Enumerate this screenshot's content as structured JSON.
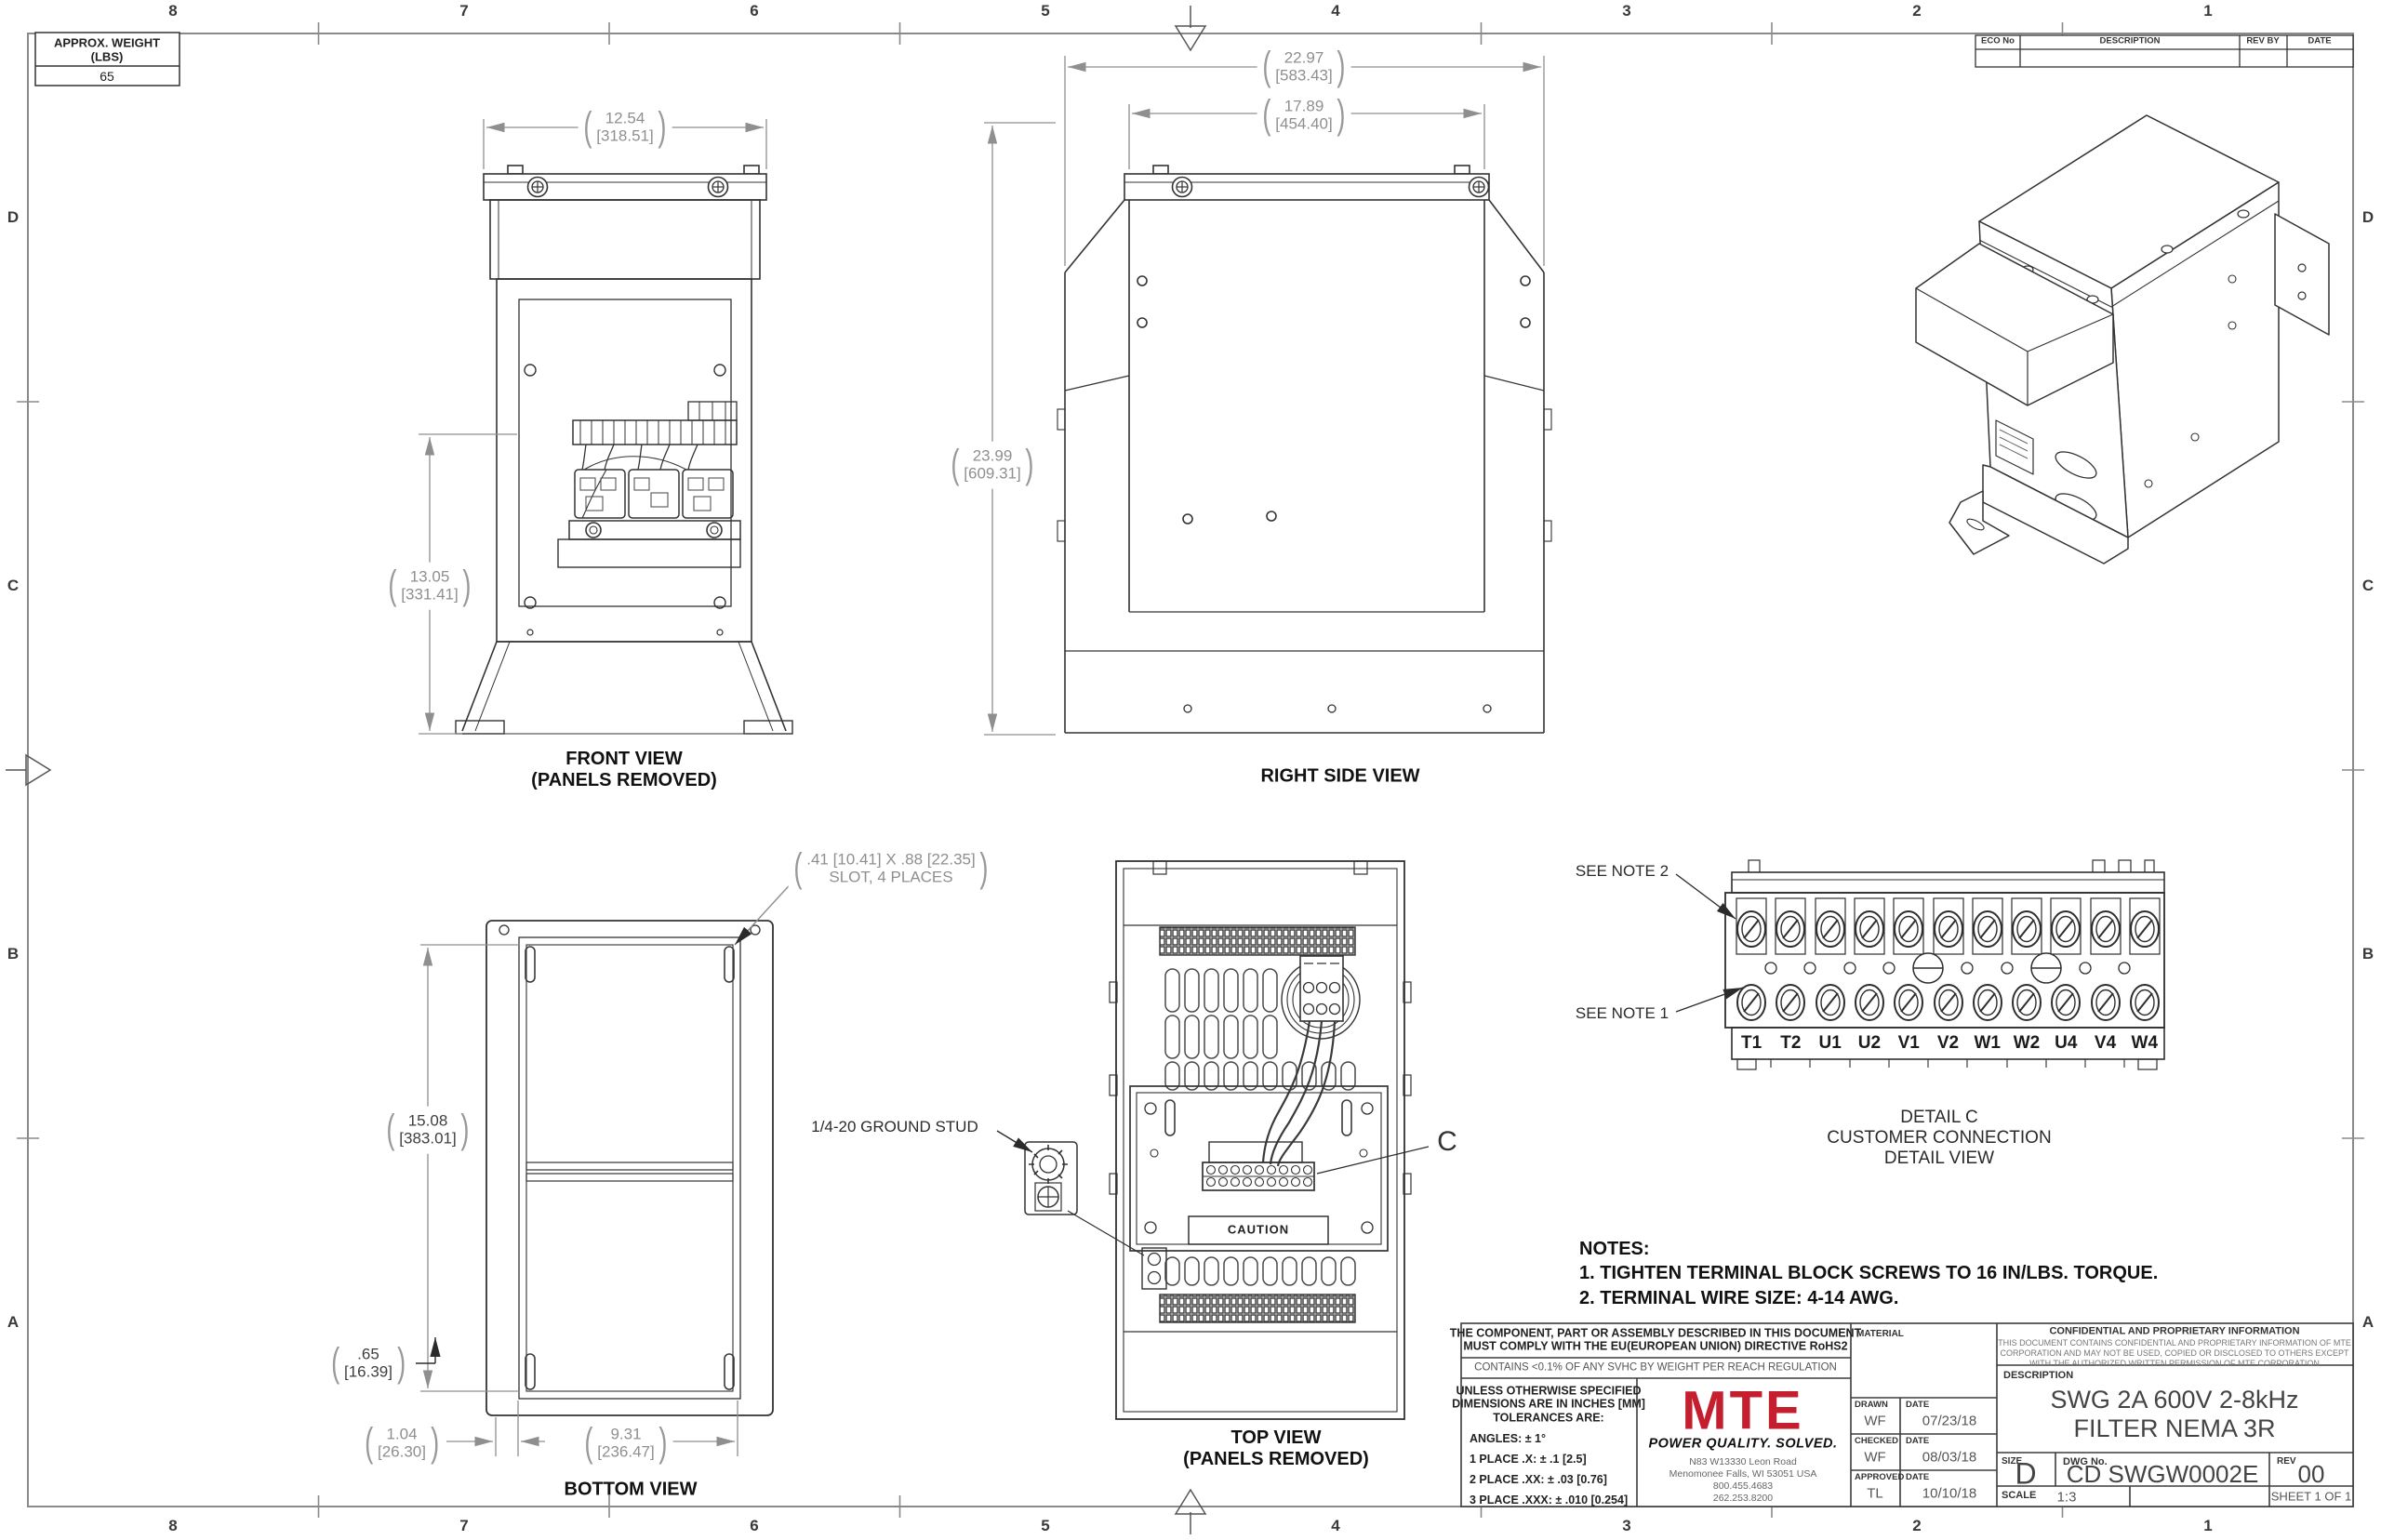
{
  "sheet": {
    "cols": [
      "8",
      "7",
      "6",
      "5",
      "4",
      "3",
      "2",
      "1"
    ],
    "rows": [
      "D",
      "C",
      "B",
      "A"
    ]
  },
  "weight_box": {
    "line1": "APPROX. WEIGHT",
    "line2": "(LBS)",
    "value": "65"
  },
  "eco_table": {
    "col1": "ECO No",
    "col2": "DESCRIPTION",
    "col3": "REV BY",
    "col4": "DATE"
  },
  "views": {
    "front": {
      "label_line1": "FRONT VIEW",
      "label_line2": "(PANELS REMOVED)",
      "dim_width": {
        "in": "12.54",
        "mm": "[318.51]"
      },
      "dim_height": {
        "in": "13.05",
        "mm": "[331.41]"
      }
    },
    "right_side": {
      "label": "RIGHT SIDE VIEW",
      "dim_overall_width": {
        "in": "22.97",
        "mm": "[583.43]"
      },
      "dim_inner_width": {
        "in": "17.89",
        "mm": "[454.40]"
      },
      "dim_height": {
        "in": "23.99",
        "mm": "[609.31]"
      }
    },
    "bottom": {
      "label": "BOTTOM VIEW",
      "slot_note_line1": ".41 [10.41] X .88 [22.35]",
      "slot_note_line2": "SLOT, 4 PLACES",
      "dim_depth": {
        "in": "15.08",
        "mm": "[383.01]"
      },
      "dim_edge": {
        "in": ".65",
        "mm": "[16.39]"
      },
      "dim_offset": {
        "in": "1.04",
        "mm": "[26.30]"
      },
      "dim_span": {
        "in": "9.31",
        "mm": "[236.47]"
      }
    },
    "top": {
      "label_line1": "TOP VIEW",
      "label_line2": "(PANELS REMOVED)",
      "ground_stud_label": "1/4-20 GROUND STUD",
      "caution_label": "CAUTION",
      "detail_ref": "C"
    }
  },
  "detail_c": {
    "see_note_2": "SEE NOTE 2",
    "see_note_1": "SEE NOTE 1",
    "terminals": [
      "T1",
      "T2",
      "U1",
      "U2",
      "V1",
      "V2",
      "W1",
      "W2",
      "U4",
      "V4",
      "W4"
    ],
    "caption_line1": "DETAIL C",
    "caption_line2": "CUSTOMER CONNECTION",
    "caption_line3": "DETAIL VIEW"
  },
  "notes": {
    "title": "NOTES:",
    "items": [
      "1.  TIGHTEN TERMINAL BLOCK SCREWS TO 16 IN/LBS. TORQUE.",
      "2.  TERMINAL WIRE SIZE: 4-14 AWG."
    ]
  },
  "title_block": {
    "compliance_line1": "THE COMPONENT, PART OR ASSEMBLY DESCRIBED IN THIS DOCUMENT",
    "compliance_line2": "MUST COMPLY WITH THE EU(EUROPEAN UNION) DIRECTIVE RoHS2",
    "reach": "CONTAINS <0.1% OF ANY SVHC BY WEIGHT PER REACH REGULATION",
    "tolerances": {
      "header_line1": "UNLESS OTHERWISE SPECIFIED",
      "header_line2": "DIMENSIONS ARE IN INCHES [MM]",
      "header_line3": "TOLERANCES ARE:",
      "angles": "ANGLES: ± 1°",
      "place1": "1 PLACE .X: ± .1 [2.5]",
      "place2": "2 PLACE .XX: ± .03 [0.76]",
      "place3": "3 PLACE .XXX: ± .010 [0.254]"
    },
    "brand": {
      "logo": "MTE",
      "tagline": "POWER QUALITY. SOLVED.",
      "address_line1": "N83 W13330 Leon Road",
      "address_line2": "Menomonee Falls, WI 53051 USA",
      "address_line3": "800.455.4683",
      "address_line4": "262.253.8200"
    },
    "material_label": "MATERIAL",
    "signoff": [
      {
        "role": "DRAWN",
        "name": "WF",
        "date_label": "DATE",
        "date": "07/23/18"
      },
      {
        "role": "CHECKED",
        "name": "WF",
        "date_label": "DATE",
        "date": "08/03/18"
      },
      {
        "role": "APPROVED",
        "name": "TL",
        "date_label": "DATE",
        "date": "10/10/18"
      }
    ],
    "confidential": {
      "title": "CONFIDENTIAL AND PROPRIETARY INFORMATION",
      "body_line1": "THIS DOCUMENT CONTAINS CONFIDENTIAL AND PROPRIETARY INFORMATION OF MTE",
      "body_line2": "CORPORATION AND MAY NOT BE USED, COPIED OR DISCLOSED TO OTHERS EXCEPT",
      "body_line3": "WITH THE AUTHORIZED WRITTEN PERMISSION OF MTE CORPORATION"
    },
    "description_label": "DESCRIPTION",
    "description_line1": "SWG 2A 600V 2-8kHz",
    "description_line2": "FILTER NEMA 3R",
    "size_label": "SIZE",
    "size": "D",
    "dwg_label": "DWG No.",
    "dwg_no": "CD SWGW0002E",
    "rev_label": "REV",
    "rev": "00",
    "scale_label": "SCALE",
    "scale": "1:3",
    "sheet_text": "SHEET 1  OF 1"
  },
  "colors": {
    "accent_red": "#c41e2f",
    "line": "#333333",
    "dim_gray": "#8f8f8f"
  }
}
